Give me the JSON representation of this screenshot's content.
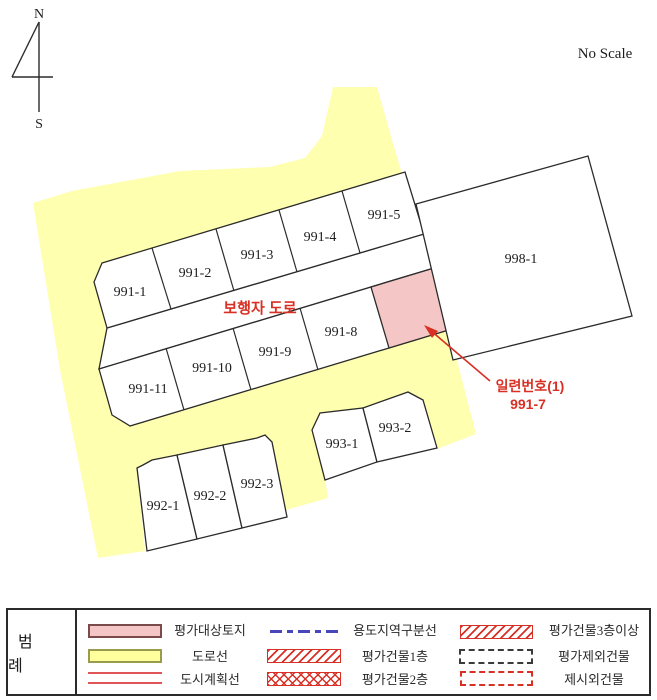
{
  "header": {
    "no_scale": "No Scale",
    "compass_north": "N",
    "compass_south": "S"
  },
  "map": {
    "road_label": "보행자 도로",
    "annotation": {
      "line1": "일련번호(1)",
      "line2": "991-7"
    },
    "parcels": {
      "991-1": "991-1",
      "991-2": "991-2",
      "991-3": "991-3",
      "991-4": "991-4",
      "991-5": "991-5",
      "991-8": "991-8",
      "991-9": "991-9",
      "991-10": "991-10",
      "991-11": "991-11",
      "998-1": "998-1",
      "992-1": "992-1",
      "992-2": "992-2",
      "992-3": "992-3",
      "993-1": "993-1",
      "993-2": "993-2"
    },
    "highlighted_parcel": "991-7"
  },
  "legend": {
    "title": "범 례",
    "items": [
      {
        "swatch": "pink-box-swatch",
        "label": "평가대상토지"
      },
      {
        "swatch": "blue-dashed-line-swatch",
        "label": "용도지역구분선"
      },
      {
        "swatch": "red-hatch-swatch",
        "label": "평가건물3층이상"
      },
      {
        "swatch": "yellow-box-swatch",
        "label": "도로선"
      },
      {
        "swatch": "red-hatch-swatch",
        "label": "평가건물1층"
      },
      {
        "swatch": "black-dashed-box-swatch",
        "label": "평가제외건물"
      },
      {
        "swatch": "red-double-line-swatch",
        "label": "도시계획선"
      },
      {
        "swatch": "red-crosshatch-swatch",
        "label": "평가건물2층"
      },
      {
        "swatch": "red-dashed-box-swatch",
        "label": "제시외건물"
      }
    ]
  },
  "colors": {
    "road_yellow": "#ffffb0",
    "parcel_white": "#ffffff",
    "target_pink": "#f5c6c6",
    "outline_black": "#2b2b2b",
    "accent_red": "#d93025",
    "accent_blue": "#4747bb"
  }
}
